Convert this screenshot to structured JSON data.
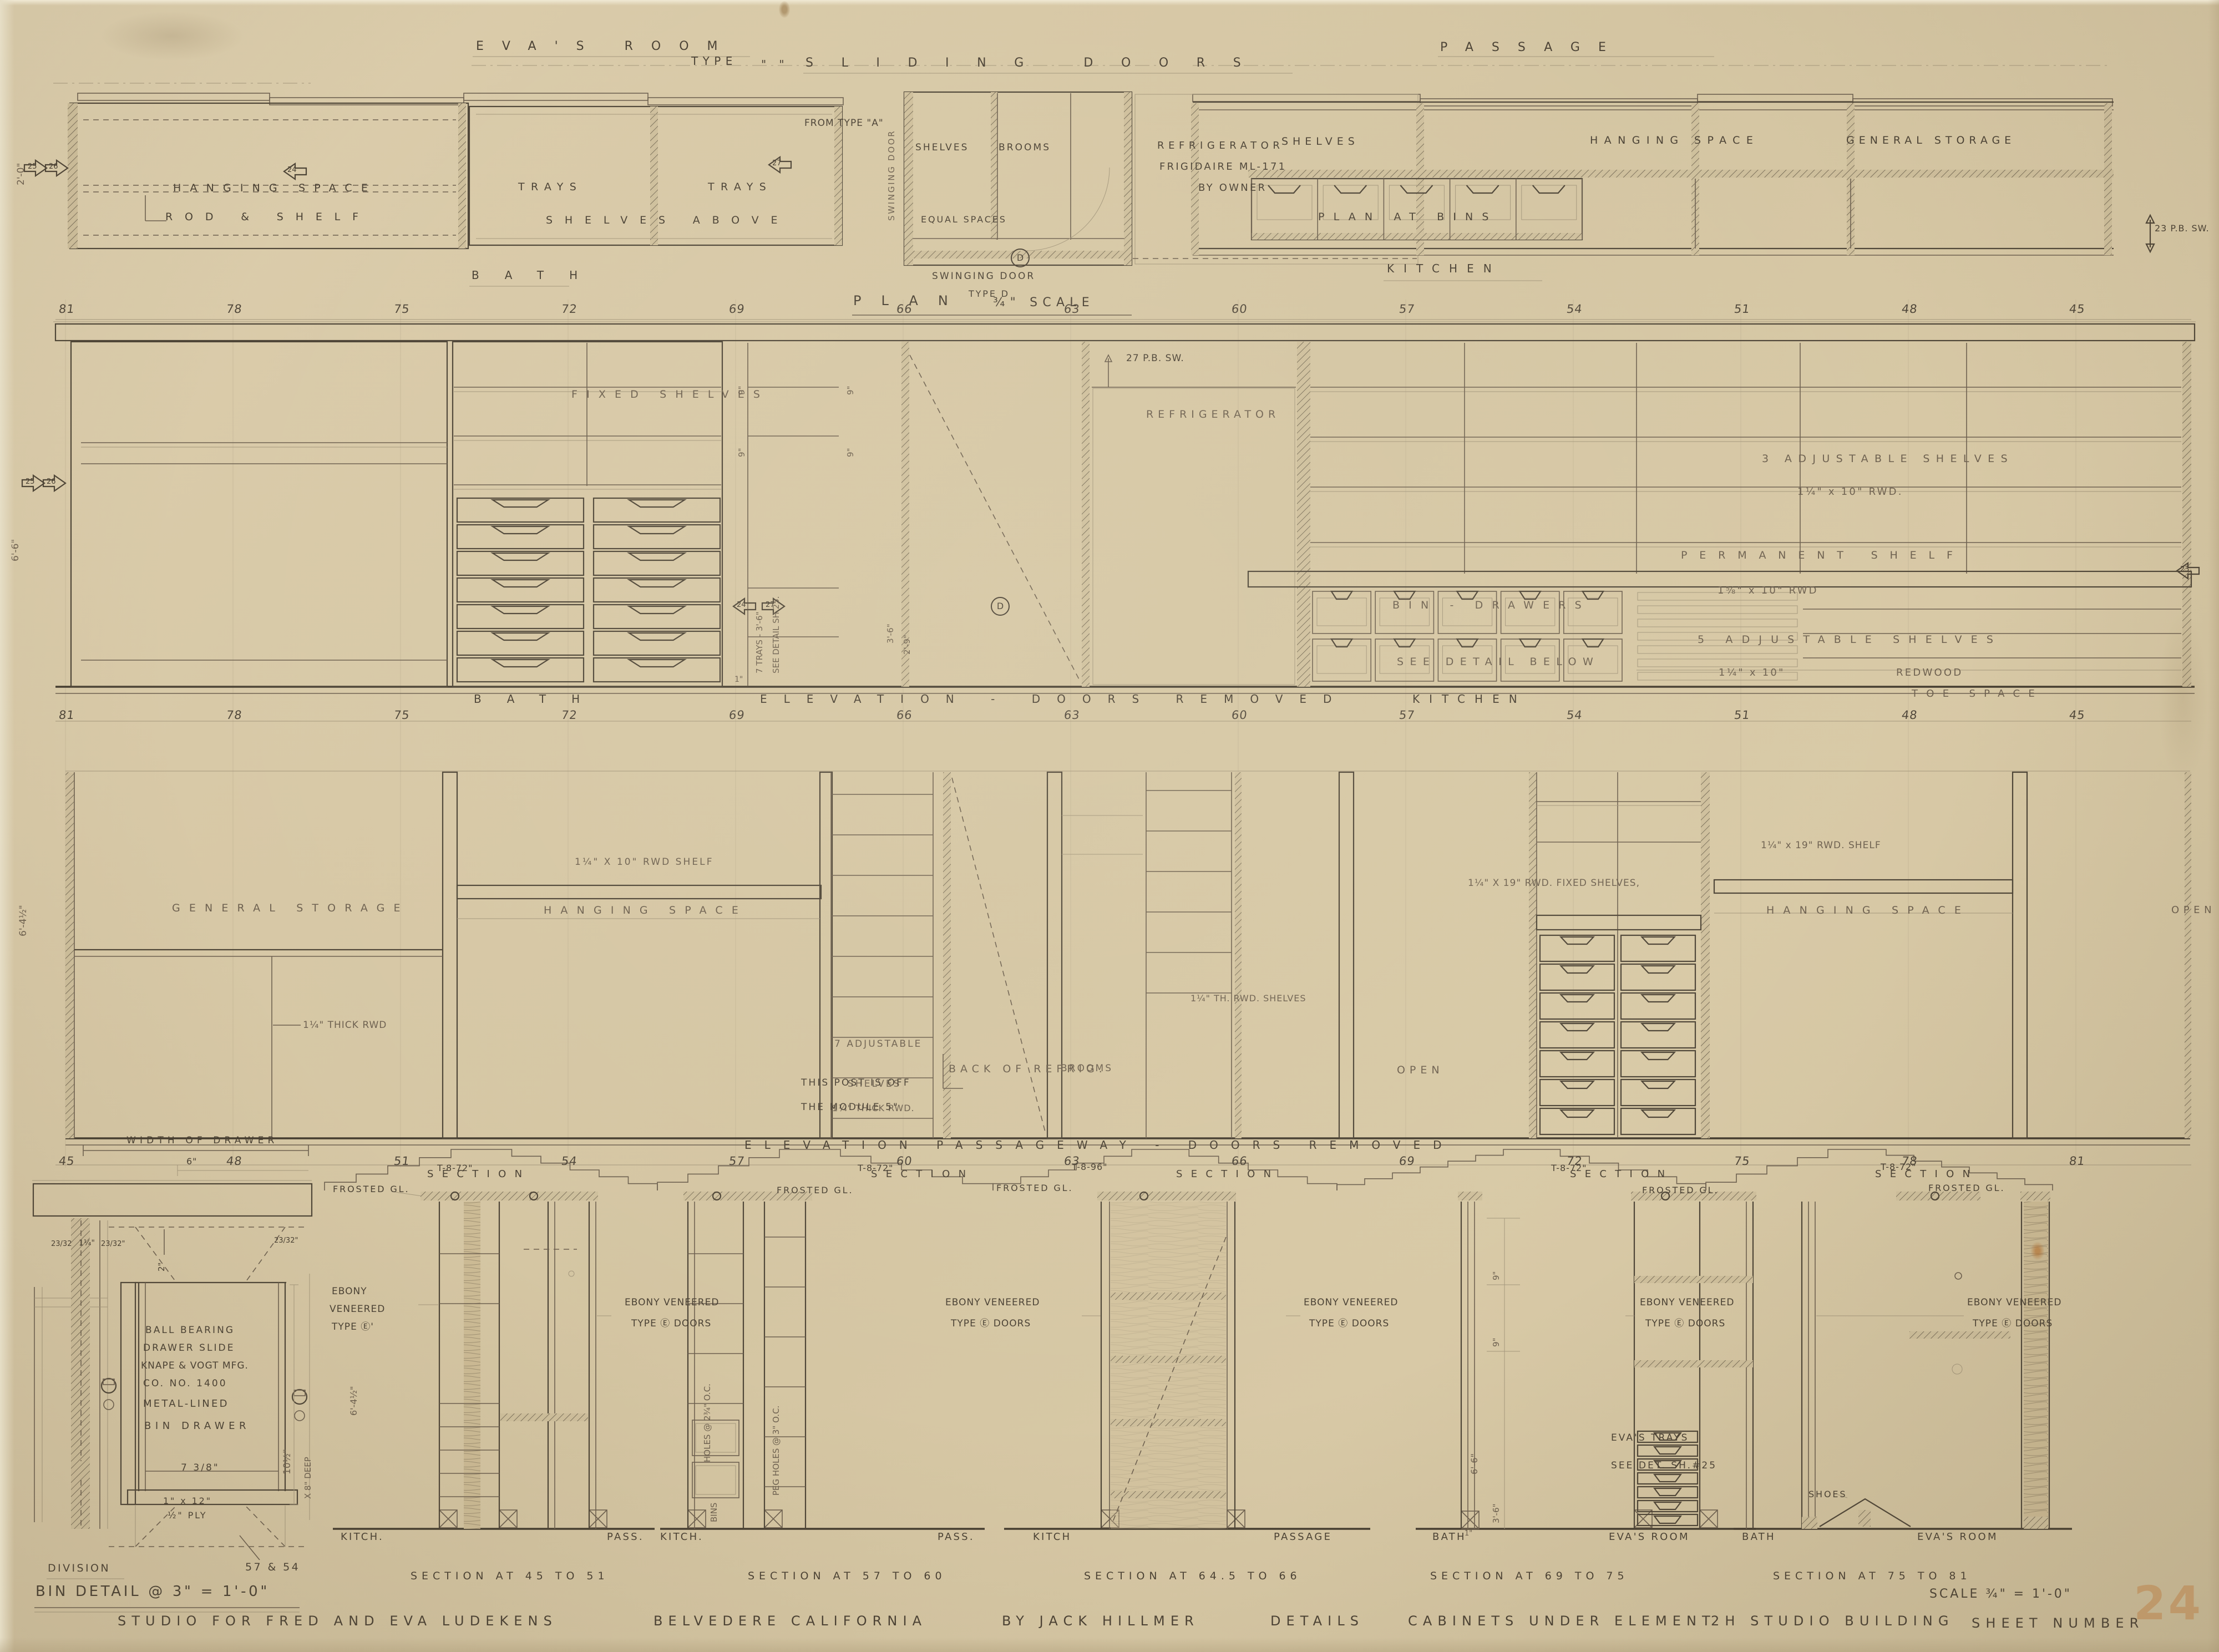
{
  "header": {
    "evas_room": "EVA'S ROOM",
    "type": "TYPE",
    "quotes": "\"  \"",
    "sliding_doors": "SLIDING DOORS",
    "passage": "PASSAGE"
  },
  "rooms": {
    "bath": "BATH",
    "kitchen": "KITCHEN",
    "evas": "EVA'S ROOM",
    "passage": "PASSAGE",
    "kitch": "KITCH.",
    "pass": "PASS.",
    "kitch2": "KITCH",
    "open": "OPEN",
    "hanging": "HANGING SPACE",
    "general": "GENERAL STORAGE"
  },
  "plan": {
    "rod_shelf": "ROD & SHELF",
    "trays": "TRAYS",
    "shelves_above": "SHELVES ABOVE",
    "from_type_a": "FROM TYPE \"A\"",
    "swinging_door": "SWINGING DOOR",
    "shelves": "SHELVES",
    "brooms": "BROOMS",
    "refrigerator": "REFRIGERATOR",
    "frigidaire": "FRIGIDAIRE ML-171",
    "by_owner": "BY OWNER",
    "equal_spaces": "EQUAL SPACES",
    "plan_at_bins": "PLAN AT BINS",
    "pb_switch": "23 P.B. SW.",
    "type_d": "TYPE D",
    "plan_title": "PLAN",
    "plan_scale": "¾\" SCALE"
  },
  "elev1": {
    "fixed_shelves": "FIXED SHELVES",
    "pb_switch": "27 P.B. SW.",
    "adjustable3": "3 ADJUSTABLE SHELVES",
    "adjustable3_dim": "1¼\" x 10\" RWD.",
    "permanent_shelf": "PERMANENT SHELF",
    "permanent_dim": "1⅝\" x 10\" RWD",
    "adjustable5": "5 ADJUSTABLE SHELVES",
    "adjustable5_dim": "1¼\" x 10\"",
    "redwood": "REDWOOD",
    "bin_drawers": "BIN - DRAWERS",
    "see_detail_below": "SEE DETAIL BELOW",
    "toe_space": "TOE SPACE",
    "title": "ELEVATION - DOORS REMOVED",
    "trays7": "7 TRAYS - 3'-6\"",
    "see_sh25": "SEE DETAIL SH 25."
  },
  "elev2": {
    "thick_rwd": "1¼\" THICK RWD",
    "rwd_shelf10": "1¼\" X 10\" RWD SHELF",
    "adj7_1": "7 ADJUSTABLE",
    "adj7_2": "SHELVES",
    "adj7_3": "1¼\" THICK RWD.",
    "back_refrig": "BACK OF REFRIG.",
    "th_shelves": "1¼\" TH. RWD. SHELVES",
    "fixed19": "1¼\" X 19\" RWD. FIXED SHELVES,",
    "shelf19": "1¼\" x 19\" RWD. SHELF",
    "post_note1": "THIS POST IS OFF",
    "post_note2": "THE MODULE 5\"",
    "title": "ELEVATION  PASSAGEWAY - DOORS REMOVED"
  },
  "sections": {
    "word": "SECTION",
    "t8_72": "T-8-72\"",
    "t8_96": "T-8-96\"",
    "frosted": "FROSTED GL.",
    "ebony_v": "EBONY VENEERED",
    "ebony_d": "TYPE Ⓔ DOORS",
    "ebony1": "EBONY",
    "ebony2": "VENEERED",
    "ebony3": "TYPE Ⓔ'",
    "holes": "HOLES @ 2¾\" O.C.",
    "peg": "PEG HOLES @ 3\" O.C.",
    "bins": "BINS",
    "evas_trays": "EVA'S TRAYS",
    "see_det": "SEE DET. SH.#25",
    "shoes": "SHOES",
    "title_s1": "SECTION AT 45 TO 51",
    "title_s2": "SECTION AT 57 TO 60",
    "title_s3": "SECTION AT 64.5 TO 66",
    "title_s4": "SECTION AT 69 TO 75",
    "title_s5": "SECTION AT 75 TO 81"
  },
  "dims": {
    "d9": "9\"",
    "d36": "3'-6\"",
    "d29": "2'-9\"",
    "d66": "6'-6\"",
    "d645": "6'-4½\"",
    "d20": "2'-0\"",
    "d1": "1\"",
    "d2": "2\"",
    "d10h": "10½\"",
    "d8deep": "X 8\" DEEP"
  },
  "bin": {
    "width_of_drawer": "WIDTH OF DRAWER",
    "six": "6\"",
    "frac_a": "23/32",
    "frac_b": "1¼\"",
    "frac_c": "23/32\"",
    "ball_bearing": "BALL BEARING",
    "drawer_slide": "DRAWER SLIDE",
    "knape": "KNAPE & VOGT MFG.",
    "co_no": "CO.  NO.  1400",
    "metal_lined": "METAL-LINED",
    "bin_drawer": "BIN DRAWER",
    "seven38": "7 3/8\"",
    "one_by": "1\" x 12\"",
    "ply": "½\" PLY",
    "division": "DIVISION",
    "d5754": "57 & 54",
    "title": "BIN DETAIL @ 3\" = 1'-0\""
  },
  "title_block": {
    "project": "STUDIO FOR FRED AND EVA LUDEKENS",
    "location": "BELVEDERE CALIFORNIA",
    "architect": "BY JACK HILLMER",
    "details": "DETAILS",
    "subject": "CABINETS UNDER ELEMENT",
    "element": "2H STUDIO BUILDING",
    "sheet_label": "SHEET NUMBER",
    "scale_note": "SCALE ¾\" = 1'-0\"",
    "sheet_number": "24"
  },
  "grid": {
    "descending": [
      "81",
      "78",
      "75",
      "72",
      "69",
      "66",
      "63",
      "60",
      "57",
      "54",
      "51",
      "48",
      "45"
    ],
    "ascending": [
      "45",
      "48",
      "51",
      "54",
      "57",
      "60",
      "63",
      "66",
      "69",
      "72",
      "75",
      "78",
      "81"
    ]
  },
  "markers": {
    "a23": "23",
    "a24": "24",
    "a25": "25",
    "a26": "26",
    "a27": "27",
    "d": "D"
  },
  "colors": {
    "paper": "#d6c7a5",
    "ink": "#4b4336",
    "accent_sheet_number": "#c8803f"
  }
}
